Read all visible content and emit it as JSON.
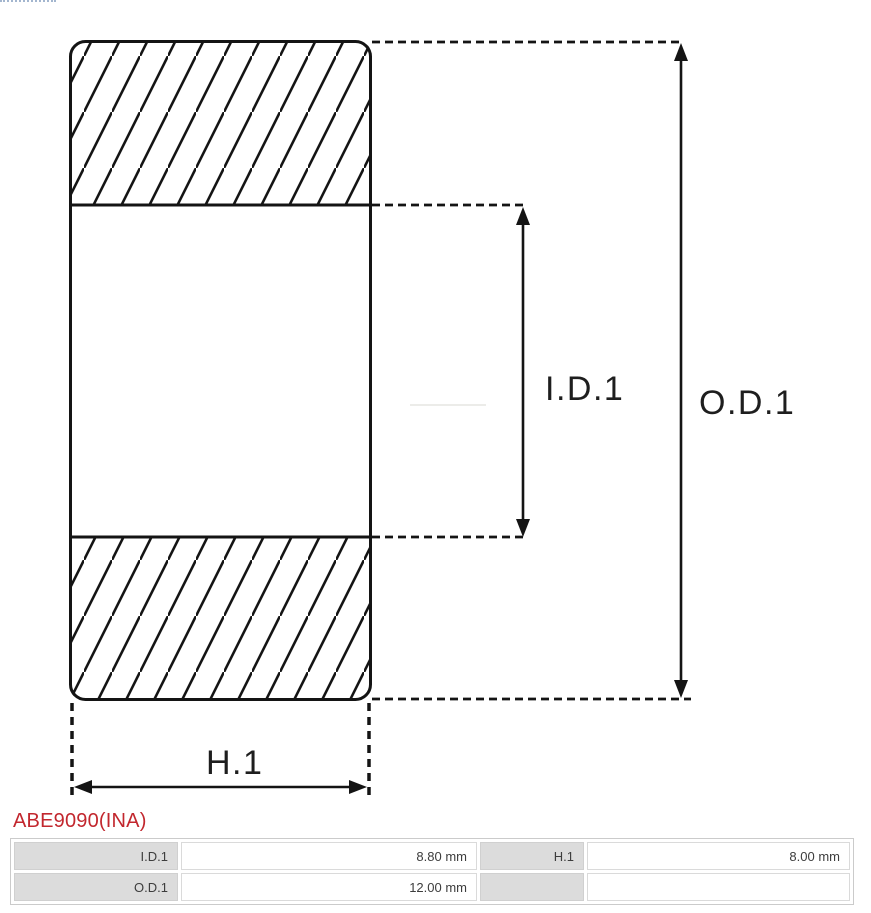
{
  "window": {
    "width": 871,
    "height": 913
  },
  "diagram": {
    "type": "bearing-cross-section",
    "dimension_labels": {
      "inner_diameter": "I.D.1",
      "outer_diameter": "O.D.1",
      "height": "H.1"
    },
    "line_color": "#141414"
  },
  "part": {
    "number": "ABE9090(INA)",
    "color": "#c2272e"
  },
  "spec_table": {
    "label_bg": "#dcdcdc",
    "rows": [
      {
        "cells": [
          {
            "label": "I.D.1",
            "value": "8.80 mm"
          },
          {
            "label": "H.1",
            "value": "8.00 mm"
          }
        ]
      },
      {
        "cells": [
          {
            "label": "O.D.1",
            "value": "12.00 mm"
          },
          {
            "label": "",
            "value": ""
          }
        ]
      }
    ]
  }
}
